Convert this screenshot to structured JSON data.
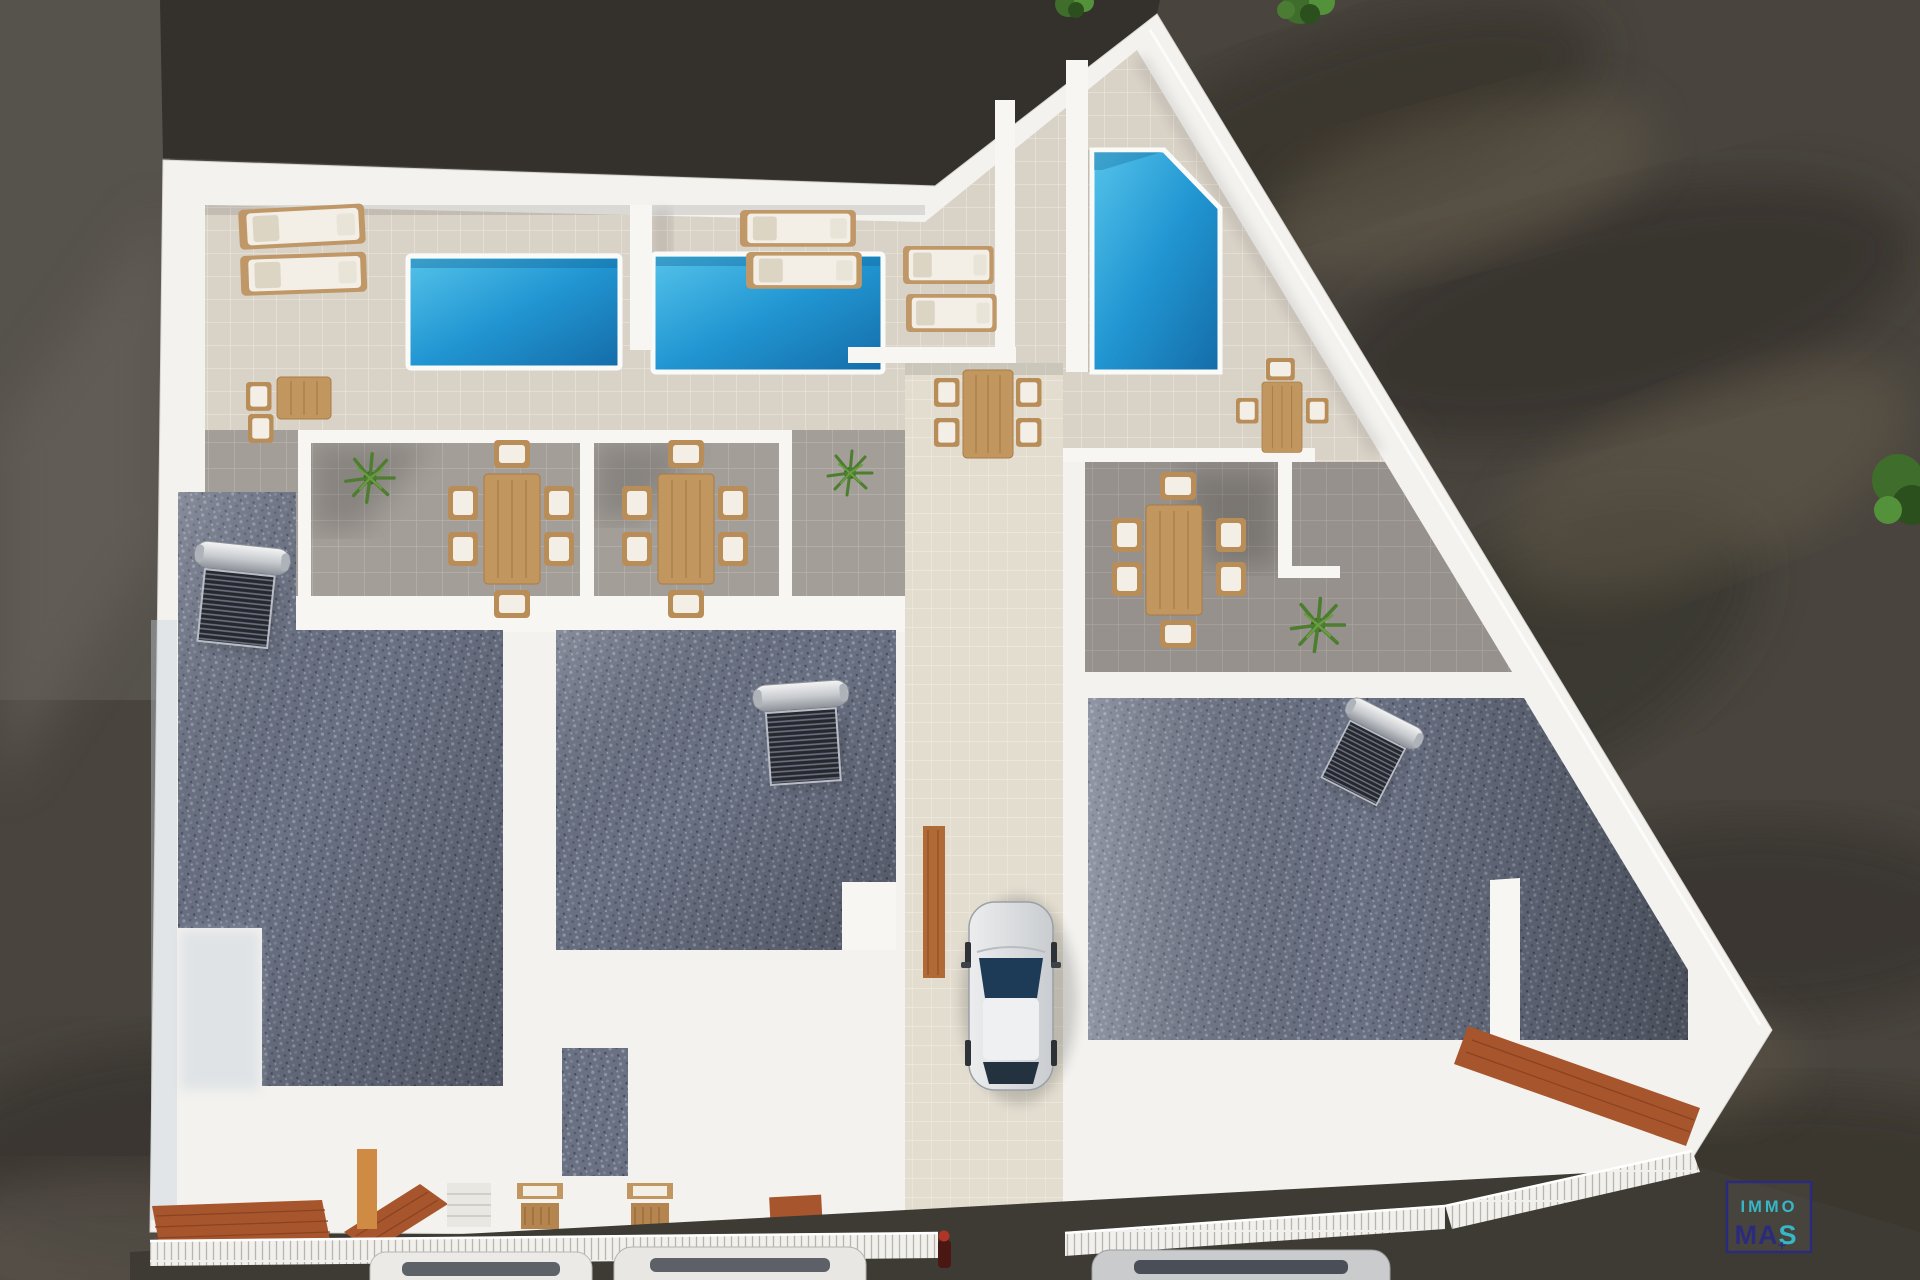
{
  "scene": {
    "type": "aerial top-down 3D architectural render",
    "subject": "modern white residential complex with rooftop pool terraces, patios, gravel roofs and driveway",
    "pools_count": 3,
    "sun_loungers_count": 6,
    "outdoor_dining_sets_count": 6,
    "solar_water_heaters_count": 3,
    "plants_count": 3,
    "cars_in_driveway_count": 1,
    "cars_on_street_count": 3
  },
  "logo": {
    "line1": "IMMO",
    "line2_left": "MA",
    "line2_right": "S",
    "plus": "+"
  },
  "colors": {
    "ground": "#49453e",
    "ground_dark": "#34302b",
    "building_white": "#f3f2ee",
    "beige_tile": "#d9d2c7",
    "gray_tile": "#a39e98",
    "drive_tile": "#e3ddd0",
    "pool_water": "#2196d2",
    "gravel": "#6a7183",
    "terracotta": "#a7552c",
    "solar_panel": "#26282e",
    "car_glass": "#1d3a57",
    "logo_navy": "#2b2b7d",
    "logo_teal": "#36b7c8"
  }
}
